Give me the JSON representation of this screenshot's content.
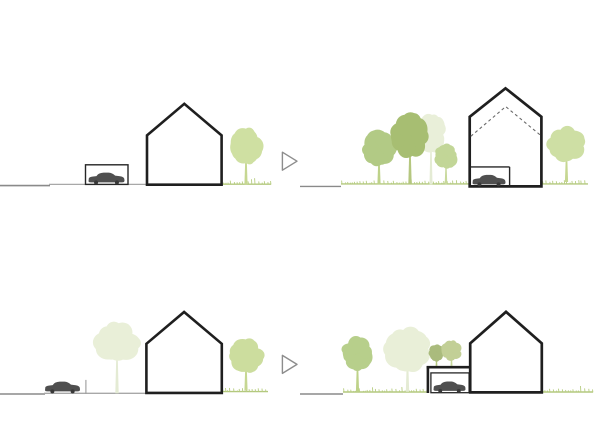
{
  "canvas": {
    "width": 600,
    "height": 430,
    "background": "#ffffff"
  },
  "palette": {
    "house_stroke": "#1f1f1f",
    "thin_stroke": "#262626",
    "car_body": "#4f4f4f",
    "car_wheel": "#383838",
    "street": "#a8a8a8",
    "street_dark": "#8a8a8a",
    "grass_line": "#b3c87e",
    "grass_tick": "#b7cd81",
    "dash_line": "#6a6a6a",
    "arrow_stroke": "#8d8d8d",
    "post": "#9b9b9b",
    "house_fill": "#ffffff"
  },
  "arrows": [
    {
      "points": "282.4,152.2 282.4,170.2 297,161.2"
    },
    {
      "points": "282.4,355.4 282.4,373.4 297,364.4"
    }
  ],
  "scenes": [
    {
      "id": "top-left",
      "streets": [
        {
          "x1": 0,
          "x2": 50,
          "y": 185.6,
          "w": 1.6,
          "dark": true
        },
        {
          "x1": 49,
          "x2": 223,
          "y": 184.4,
          "w": 1.3
        }
      ],
      "grass": [
        {
          "x1": 223,
          "x2": 271,
          "y": 184.2
        }
      ],
      "trees": [
        {
          "cx": 246,
          "cy": 146,
          "rx": 16,
          "ry": 18,
          "color": "#cfe0a2",
          "trunk_color": "#c6d792",
          "trunk_w": 3.2,
          "trunk_bottom": 184.6
        }
      ],
      "garage_rect": {
        "x": 85.5,
        "y": 164.8,
        "w": 42.5,
        "h": 19.6,
        "sw": 1.4
      },
      "house": {
        "left": 147,
        "right": 221.6,
        "bottom": 184.7,
        "eaves": 135.4,
        "peak_x": 184.3,
        "peak_y": 103.8,
        "sw": 2.6
      },
      "cars": [
        {
          "x": 88.5,
          "y": 171.8,
          "w": 36,
          "h": 12.6
        }
      ]
    },
    {
      "id": "top-right",
      "streets": [
        {
          "x1": 300,
          "x2": 341,
          "y": 186.4,
          "w": 1.4,
          "dark": true
        }
      ],
      "grass": [
        {
          "x1": 341,
          "x2": 588,
          "y": 183.9
        }
      ],
      "trees": [
        {
          "cx": 431,
          "cy": 133,
          "rx": 16,
          "ry": 19,
          "color": "#e9efd9",
          "trunk_color": "#e4ebd4",
          "trunk_w": 3,
          "trunk_bottom": 184.3
        },
        {
          "cx": 379,
          "cy": 148,
          "rx": 17.5,
          "ry": 17.5,
          "color": "#b2ca85",
          "trunk_color": "#bed289",
          "trunk_w": 3.2,
          "trunk_bottom": 184.3
        },
        {
          "cx": 410,
          "cy": 136,
          "rx": 19,
          "ry": 22,
          "color": "#a7be72",
          "trunk_color": "#b5c77f",
          "trunk_w": 3.4,
          "trunk_bottom": 184.3
        },
        {
          "cx": 446,
          "cy": 156,
          "rx": 11.5,
          "ry": 12.5,
          "color": "#c2d697",
          "trunk_color": "#c8d99c",
          "trunk_w": 2.6,
          "trunk_bottom": 184.3
        },
        {
          "cx": 566.5,
          "cy": 144.5,
          "rx": 18.5,
          "ry": 17,
          "color": "#cedfa4",
          "trunk_color": "#c6d792",
          "trunk_w": 3.2,
          "trunk_bottom": 182
        }
      ],
      "house": {
        "left": 469.7,
        "right": 541.4,
        "bottom": 186.4,
        "eaves": 116.8,
        "peak_x": 505.5,
        "peak_y": 88.3,
        "sw": 2.7
      },
      "dashed_profile": "470.8,136.3 505.7,106.6 540.5,135.2",
      "garage_inside": {
        "x1": 470.8,
        "x2": 509.6,
        "top": 166.9,
        "bottom": 186.2,
        "sw": 1.4
      },
      "cars": [
        {
          "x": 472.5,
          "y": 174,
          "w": 33,
          "h": 12.4
        }
      ]
    },
    {
      "id": "bottom-left",
      "streets": [
        {
          "x1": 0,
          "x2": 45,
          "y": 394,
          "w": 1.6,
          "dark": true
        },
        {
          "x1": 44,
          "x2": 146.5,
          "y": 393.3,
          "w": 1.3
        }
      ],
      "grass": [
        {
          "x1": 222,
          "x2": 268,
          "y": 391.6
        }
      ],
      "post": {
        "x": 85.9,
        "y1": 379.9,
        "y2": 393.7
      },
      "trees": [
        {
          "cx": 117,
          "cy": 342,
          "rx": 22,
          "ry": 19.5,
          "color": "#e9efd8",
          "trunk_color": "#e4ebd4",
          "trunk_w": 3.4,
          "trunk_bottom": 393.2
        },
        {
          "cx": 246,
          "cy": 355,
          "rx": 17,
          "ry": 17.5,
          "color": "#ccdd9e",
          "trunk_color": "#c6d792",
          "trunk_w": 3.2,
          "trunk_bottom": 390.6
        }
      ],
      "house": {
        "left": 146.4,
        "right": 221.8,
        "bottom": 392.9,
        "eaves": 343.8,
        "peak_x": 184.1,
        "peak_y": 312,
        "sw": 2.6
      },
      "cars": [
        {
          "x": 45,
          "y": 380.8,
          "w": 35,
          "h": 12.6
        }
      ]
    },
    {
      "id": "bottom-right",
      "streets": [
        {
          "x1": 300,
          "x2": 343,
          "y": 394,
          "w": 1.4,
          "dark": true
        }
      ],
      "grass": [
        {
          "x1": 343,
          "x2": 593,
          "y": 392
        }
      ],
      "trees": [
        {
          "cx": 357.5,
          "cy": 353.5,
          "rx": 15.5,
          "ry": 16,
          "color": "#b7cf8b",
          "trunk_color": "#bed289",
          "trunk_w": 3.2,
          "trunk_bottom": 391.8
        },
        {
          "cx": 407.5,
          "cy": 349,
          "rx": 23,
          "ry": 22,
          "color": "#e9efd8",
          "trunk_color": "#e4ebd4",
          "trunk_w": 3.4,
          "trunk_bottom": 391.8
        },
        {
          "cx": 436.5,
          "cy": 352.5,
          "rx": 7.5,
          "ry": 8.5,
          "color": "#aabb7d",
          "trunk_color": "#b5c77f",
          "trunk_w": 2,
          "trunk_bottom": 368
        },
        {
          "cx": 451.5,
          "cy": 351,
          "rx": 10,
          "ry": 10.5,
          "color": "#c2cf96",
          "trunk_color": "#c8d99c",
          "trunk_w": 2.2,
          "trunk_bottom": 368
        }
      ],
      "garage_attached": {
        "mask": {
          "x": 426.6,
          "y": 365.9,
          "w": 43.6,
          "h": 27
        },
        "roof_y": 367.2,
        "x1": 426.6,
        "x2": 470.2,
        "wall_x": 427.9,
        "wall_y2": 393,
        "sw": 2.6,
        "inner": {
          "x": 430.9,
          "y": 372.9,
          "w": 38.2,
          "h": 19.8,
          "sw": 1.3
        }
      },
      "house": {
        "left": 470.2,
        "right": 541.8,
        "bottom": 392.4,
        "eaves": 343.3,
        "peak_x": 506,
        "peak_y": 311.8,
        "sw": 2.7
      },
      "cars": [
        {
          "x": 433.5,
          "y": 380.6,
          "w": 32,
          "h": 12.2
        }
      ]
    }
  ]
}
